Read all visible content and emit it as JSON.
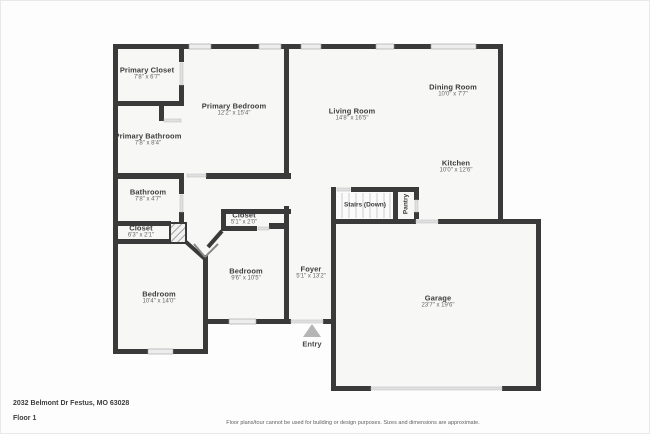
{
  "page": {
    "address": "2032 Belmont Dr Festus, MO 63028",
    "floor_label": "Floor 1",
    "disclaimer": "Floor plans/tour cannot be used for building or design purposes. Sizes and dimensions are approximate."
  },
  "colors": {
    "wall": "#3a3a3a",
    "floor": "#f7f7f6",
    "window": "#ededed",
    "door": "#e0e0e0",
    "tread": "#d5d5d5",
    "entry_arrow": "#b5b5b5"
  },
  "rooms": [
    {
      "name": "Primary Closet",
      "dims": "7'8\" x 6'7\""
    },
    {
      "name": "Primary Bathroom",
      "dims": "7'8\" x 8'4\""
    },
    {
      "name": "Primary Bedroom",
      "dims": "12'2\" x 15'4\""
    },
    {
      "name": "Bathroom",
      "dims": "7'8\" x 4'7\""
    },
    {
      "name": "Closet",
      "dims": "6'3\" x 2'1\""
    },
    {
      "name": "Closet",
      "dims": "5'1\" x 2'0\""
    },
    {
      "name": "Bedroom",
      "dims": "9'6\" x 10'5\""
    },
    {
      "name": "Bedroom",
      "dims": "10'4\" x 14'0\""
    },
    {
      "name": "Foyer",
      "dims": "5'1\" x 13'2\""
    },
    {
      "name": "Living Room",
      "dims": "14'8\" x 16'5\""
    },
    {
      "name": "Dining Room",
      "dims": "10'0\" x 7'7\""
    },
    {
      "name": "Kitchen",
      "dims": "10'0\" x 12'6\""
    },
    {
      "name": "Garage",
      "dims": "23'7\" x 19'6\""
    }
  ],
  "features": {
    "stairs": "Stairs (Down)",
    "pantry": "Pantry",
    "entry": "Entry"
  }
}
